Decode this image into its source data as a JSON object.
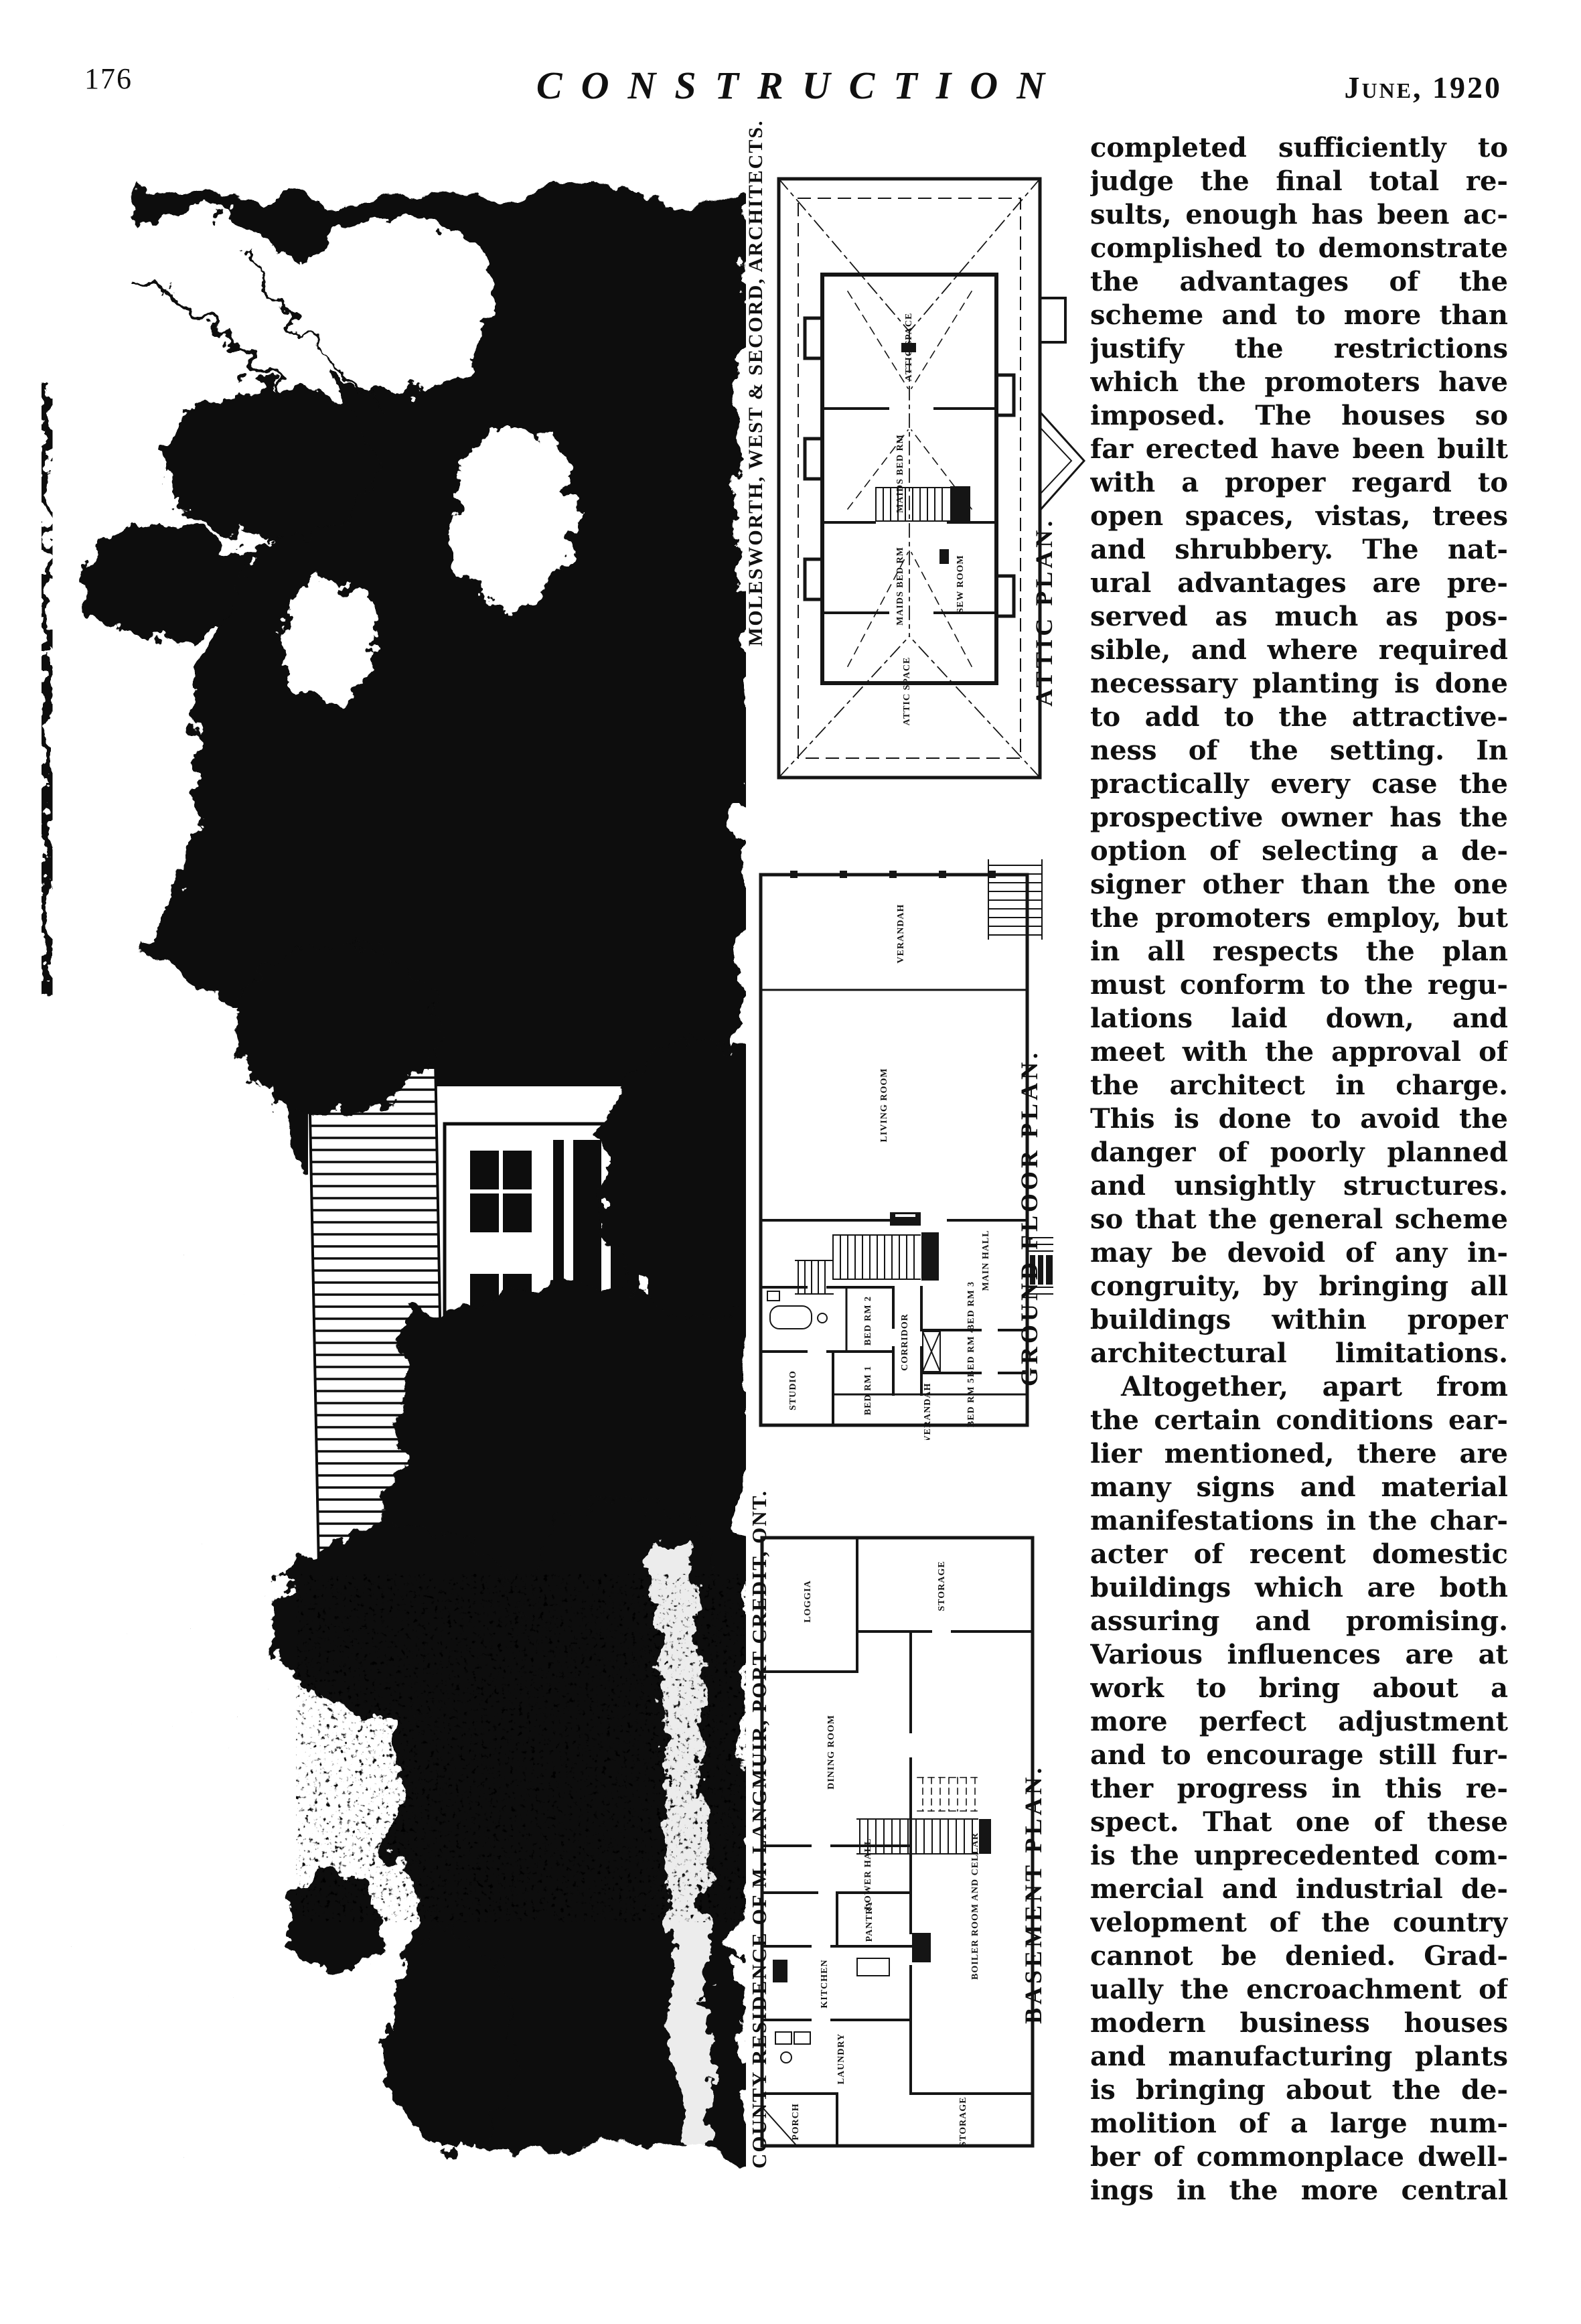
{
  "header": {
    "page_number": "176",
    "journal_title": "CONSTRUCTION",
    "issue_date": "June, 1920"
  },
  "captions": {
    "architects": "MOLESWORTH, WEST & SECORD, ARCHITECTS.",
    "residence": "COUNTY RESIDENCE OF M. LANGMUIR, PORT CREDIT, ONT.",
    "attic": "ATTIC PLAN.",
    "ground": "GROUND FLOOR PLAN.",
    "basement": "BASEMENT PLAN."
  },
  "plans": {
    "attic": {
      "rooms": [
        "ATTIC SPACE",
        "MAIDS BED RM",
        "MAIDS BED RM",
        "SEW ROOM",
        "ATTIC SPACE"
      ]
    },
    "ground": {
      "rooms": [
        "VERANDAH",
        "LIVING ROOM",
        "MAIN HALL",
        "BED RM 2",
        "BED RM 1",
        "CORRIDOR",
        "BED RM 3",
        "BED RM 4",
        "BED RM 5",
        "STUDIO",
        "VERANDAH"
      ]
    },
    "basement": {
      "rooms": [
        "LOGGIA",
        "STORAGE",
        "DINING ROOM",
        "LOWER HALL",
        "PANTRY",
        "KITCHEN",
        "LAUNDRY",
        "BOILER ROOM AND CELLAR",
        "PORCH",
        "STORAGE"
      ]
    }
  },
  "article": {
    "paragraphs": [
      {
        "indent": false,
        "lines": [
          "completed sufficiently to",
          "judge the final total re-",
          "sults, enough has been ac-",
          "complished to demonstrate",
          "the advantages of the",
          "scheme and to more than",
          "justify the restrictions",
          "which the promoters have",
          "imposed. The houses so",
          "far erected have been built",
          "with a proper regard to",
          "open spaces, vistas, trees",
          "and shrubbery. The nat-",
          "ural advantages are pre-",
          "served as much as pos-",
          "sible, and where required",
          "necessary planting is done",
          "to add to the attractive-",
          "ness of the setting. In",
          "practically every case the",
          "prospective owner has the",
          "option of selecting a de-",
          "signer other than the one",
          "the promoters employ, but",
          "in all respects the plan",
          "must conform to the regu-",
          "lations laid down, and",
          "meet with the approval of",
          "the architect in charge.",
          "This is done to avoid the",
          "danger of poorly planned",
          "and unsightly structures.",
          "so that the general scheme",
          "may be devoid of any in-",
          "congruity, by bringing all",
          "buildings within proper",
          "architectural limitations."
        ]
      },
      {
        "indent": true,
        "lines": [
          "Altogether, apart from",
          "the certain conditions ear-",
          "lier mentioned, there are",
          "many signs and material",
          "manifestations in the char-",
          "acter of recent domestic",
          "buildings which are both",
          "assuring and promising.",
          "Various influences are at",
          "work to bring about a",
          "more perfect adjustment",
          "and to encourage still fur-",
          "ther progress in this re-",
          "spect. That one of these",
          "is the unprecedented com-",
          "mercial and industrial de-",
          "velopment of the country",
          "cannot be denied. Grad-",
          "ually the encroachment of",
          "modern business houses",
          "and manufacturing plants",
          "is bringing about the de-",
          "molition of a large num-",
          "ber of commonplace dwell-",
          "ings in the more central"
        ]
      }
    ]
  }
}
